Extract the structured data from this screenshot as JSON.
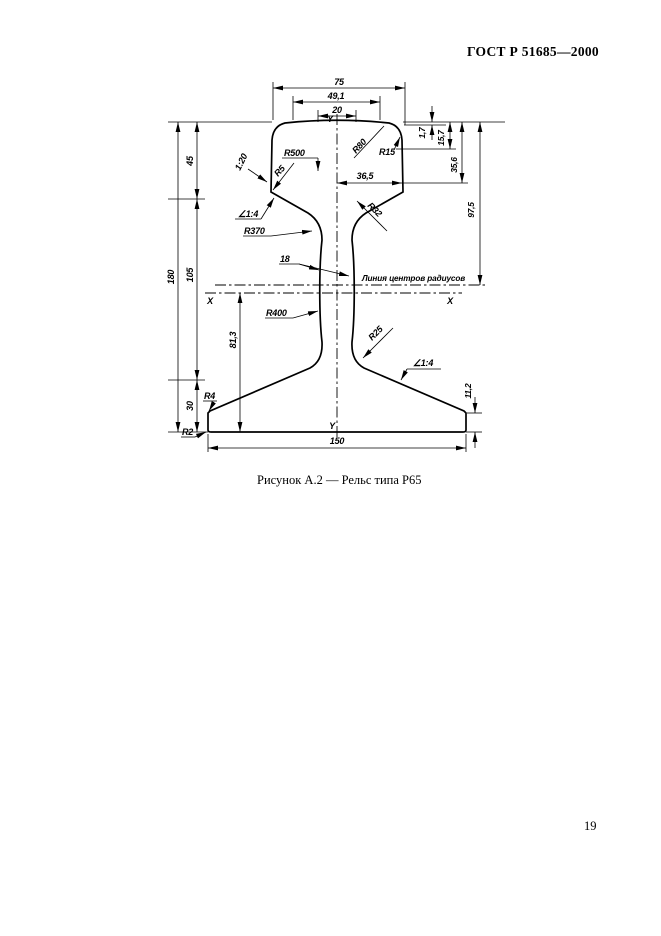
{
  "header": {
    "title": "ГОСТ Р 51685—2000"
  },
  "caption": "Рисунок А.2 — Рельс типа Р65",
  "footer": {
    "page_number": "19"
  },
  "drawing": {
    "axes": {
      "y_top": "Y",
      "y_bottom": "Y",
      "x_left": "X",
      "x_right": "X"
    },
    "note": "Линия центров радиусов",
    "dims": {
      "w75": "75",
      "w491": "49,1",
      "w20": "20",
      "w365": "36,5",
      "w18": "18",
      "w150": "150",
      "h45": "45",
      "h180": "180",
      "h105": "105",
      "h30": "30",
      "h813": "81,3",
      "r17": "1,7",
      "r157": "15,7",
      "r356": "35,6",
      "r975": "97,5",
      "r112": "11,2"
    },
    "radii": {
      "r500": "R500",
      "r80": "R80",
      "r15": "R15",
      "r5": "R5",
      "r370": "R370",
      "r32": "R32",
      "r400": "R400",
      "r25": "R25",
      "r4": "R4",
      "r2": "R2"
    },
    "slopes": {
      "s120": "1:20",
      "s14_left": "∠1:4",
      "s14_right": "∠1:4"
    }
  }
}
